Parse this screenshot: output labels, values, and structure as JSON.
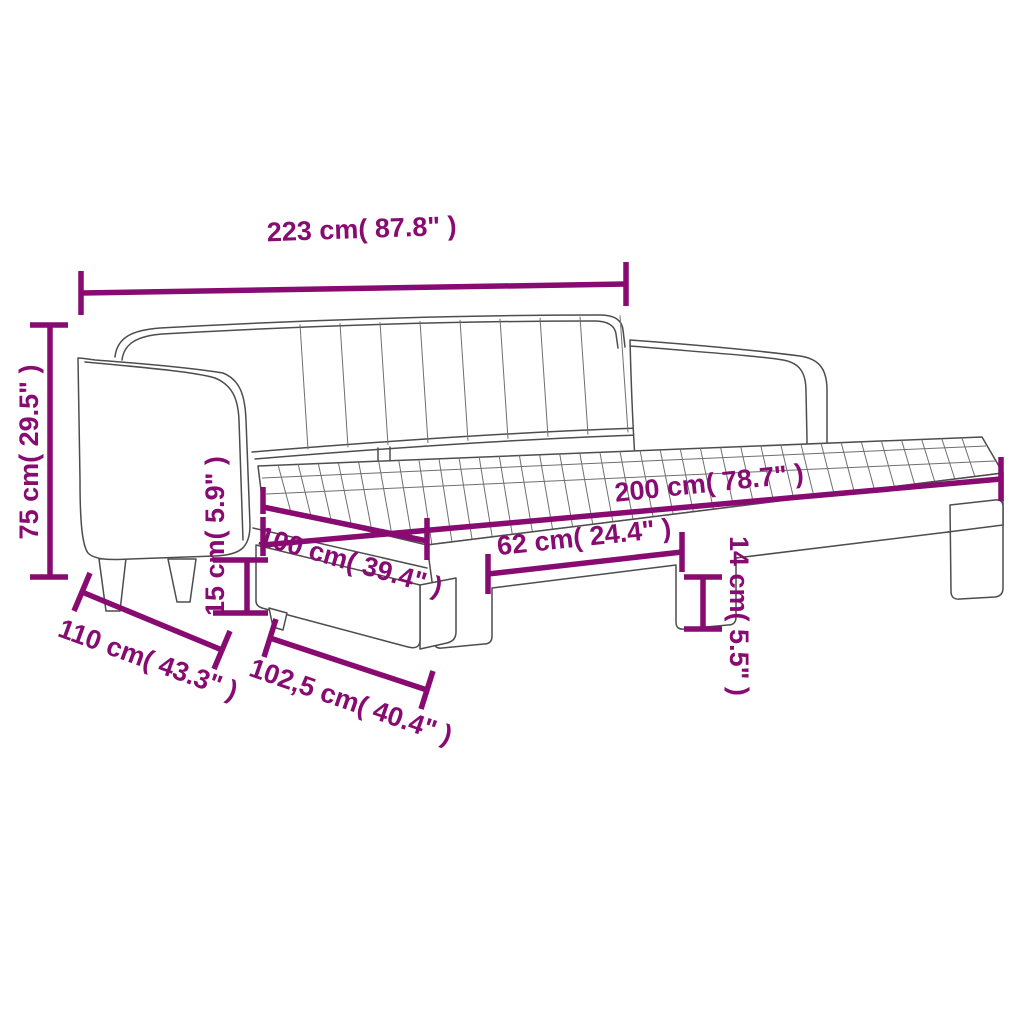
{
  "diagram": {
    "title": "Daybed with pull-out trundle - product dimension diagram",
    "background_color": "#ffffff",
    "dimension_color": "#870b71",
    "artwork_line_color": "#4d4d4d",
    "unit_style": "centimeters with inches in parentheses",
    "dimensions": {
      "overall_length": "223 cm( 87.8\" )",
      "overall_height": "75 cm( 29.5\" )",
      "mattress_length": "200 cm( 78.7\" )",
      "mattress_width": "100 cm( 39.4\" )",
      "leg_spacing": "62 cm( 24.4\" )",
      "trundle_frame_height": "14 cm( 5.5\" )",
      "underbed_clearance": "15 cm( 5.9\" )",
      "overall_depth": "110 cm( 43.3\" )",
      "trundle_depth": "102,5 cm( 40.4\" )"
    }
  }
}
